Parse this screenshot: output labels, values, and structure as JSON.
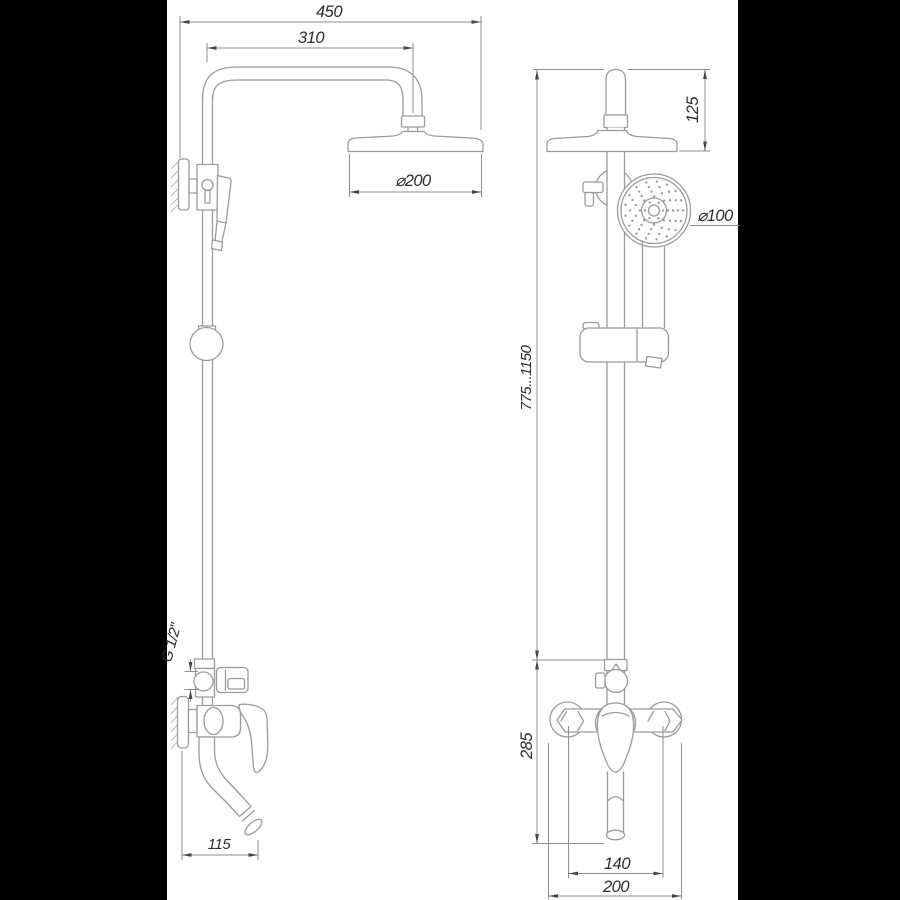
{
  "drawing": {
    "dimensions": {
      "arm_width": "450",
      "arm_projection": "310",
      "head_diameter": "⌀200",
      "head_height": "125",
      "hand_shower_diameter": "⌀100",
      "column_height_range": "775...1150",
      "mixer_section_height": "285",
      "thread_size": "G 1/2\"",
      "spout_reach": "115",
      "connection_spacing": "140",
      "mixer_width": "200"
    },
    "colors": {
      "background": "#ffffff",
      "letterbox": "#000000",
      "product_line": "#9b9b9b",
      "dimension_line": "#8e8e8e",
      "text": "#2d2d2d"
    }
  }
}
